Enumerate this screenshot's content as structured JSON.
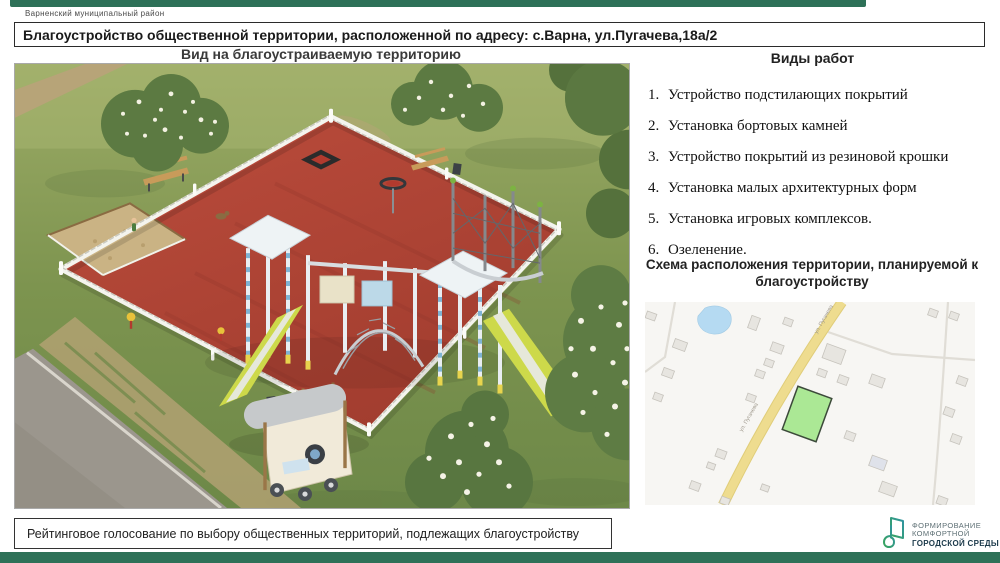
{
  "page": {
    "municipality": "Варненский муниципальный район",
    "title": "Благоустройство общественной территории, расположенной по адресу: с.Варна, ул.Пугачева,18а/2",
    "footer_note": "Рейтинговое голосование по выбору общественных территорий, подлежащих  благоустройству"
  },
  "left_panel": {
    "image_title": "Вид на благоустраиваемую территорию"
  },
  "right_panel": {
    "works_title": "Виды работ",
    "works": [
      {
        "num": "1.",
        "label": "Устройство подстилающих покрытий"
      },
      {
        "num": "2.",
        "label": "Установка бортовых камней"
      },
      {
        "num": "3.",
        "label": "Устройство покрытий из резиновой крошки"
      },
      {
        "num": "4.",
        "label": "Установка малых архитектурных форм"
      },
      {
        "num": "5.",
        "label": "Установка игровых комплексов."
      },
      {
        "num": "6.",
        "label": "Озеленение."
      }
    ],
    "map_title": "Схема расположения территории, планируемой к благоустройству",
    "map": {
      "street_label": "ул. Пугачева"
    }
  },
  "logo": {
    "line1": "ФОРМИРОВАНИЕ",
    "line2": "КОМФОРТНОЙ",
    "line3": "ГОРОДСКОЙ СРЕДЫ"
  },
  "colors": {
    "accent_bar": "#2e7158",
    "playground_surface": "#b54a3a",
    "map_parcel_fill": "#abe895",
    "map_road_yellow": "#eedc8f",
    "logo_green": "#38a45c",
    "logo_teal": "#2f93a3"
  }
}
